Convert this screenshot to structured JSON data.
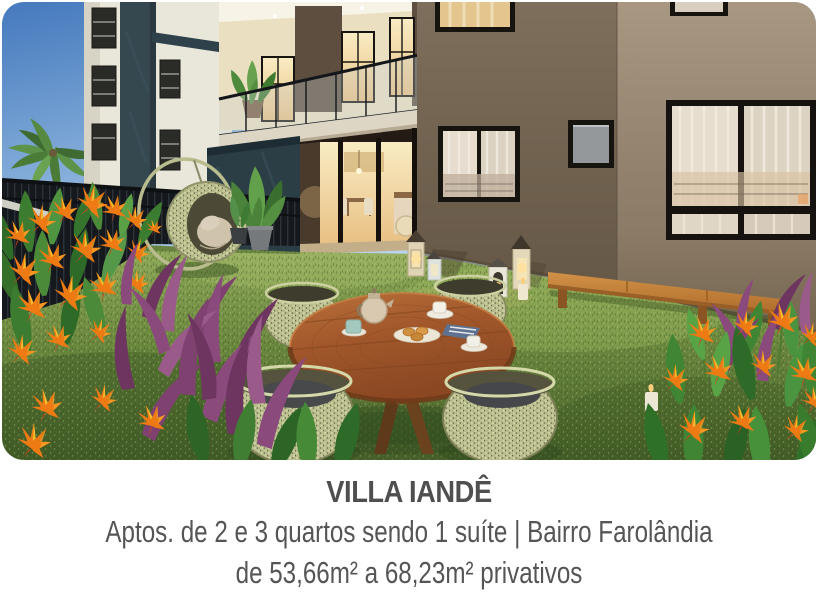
{
  "caption": {
    "title": "VILLA IANDÊ",
    "line1": "Aptos. de 2 e 3 quartos sendo 1 suíte | Bairro Farolândia",
    "line2": "de 53,66m² a 68,23m² privativos"
  },
  "hero": {
    "alt": "Perspectiva ilustrada do jardim do condomínio: mesa redonda de madeira com café, cadeiras de fibra trançada, balanço suspenso, banco de madeira junto à fachada, lanternas no gramado e flores tropicais laranjas",
    "colors": {
      "sky_blue": "#4479bd",
      "facade_taupe": "#a89781",
      "facade_white": "#e9e6da",
      "accent_teal": "#2b3e46",
      "warm_window": "#f6e2ae",
      "grass_green": "#6d8a40",
      "table_wood": "#a0562a",
      "bench_wood": "#c8883f",
      "wicker": "#b6b988",
      "flower_orange": "#ee7a14",
      "foliage_purple": "#8a4a7c",
      "text_gray": "#4f4f4f"
    }
  }
}
